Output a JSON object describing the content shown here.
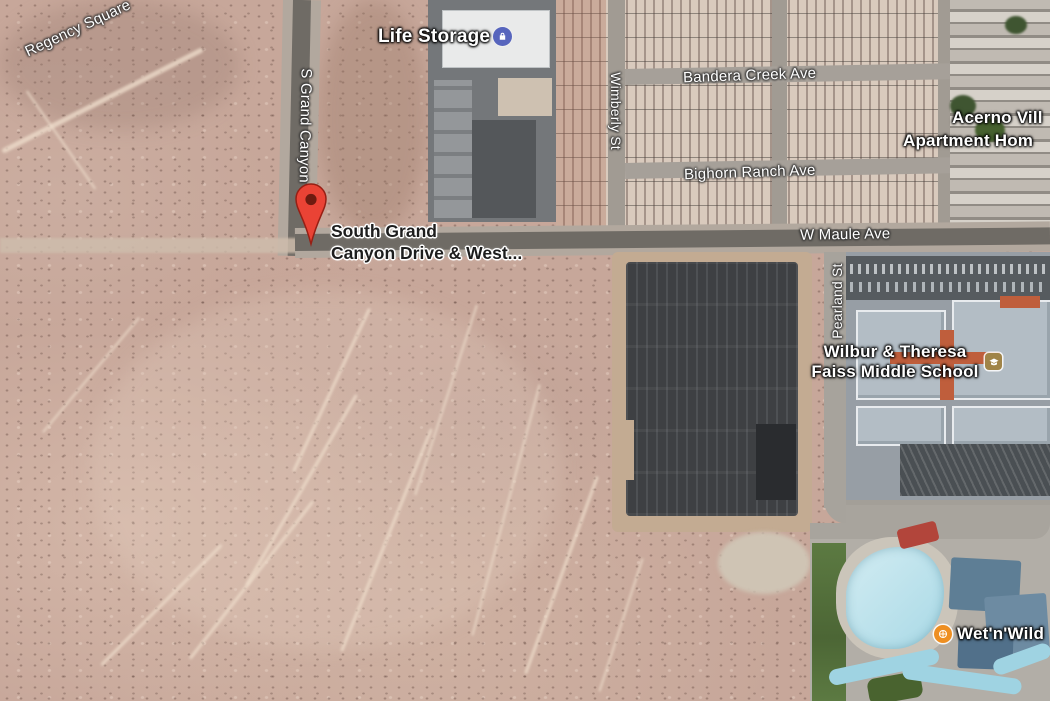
{
  "map": {
    "view": "satellite",
    "road_labels": {
      "regency_square": "Regency Square",
      "s_grand_canyon_dr": "S Grand Canyon",
      "wimberly_st": "Wimberly St",
      "bandera_creek_ave": "Bandera Creek Ave",
      "bighorn_ranch_ave": "Bighorn Ranch Ave",
      "w_maule_ave": "W Maule Ave",
      "pearland_st": "Pearland St"
    },
    "poi_labels": {
      "life_storage": "Life Storage",
      "acerno_line1": "Acerno Vill",
      "acerno_line2": "Apartment Hom",
      "school_line1": "Wilbur & Theresa",
      "school_line2": "Faiss Middle School",
      "wet_n_wild": "Wet'n'Wild"
    },
    "marker": {
      "title_line1": "South Grand",
      "title_line2": "Canyon Drive & West...",
      "pin_color": "#EA4335"
    },
    "icon_colors": {
      "life_storage_icon": "#5765BD",
      "school_icon": "#A08448",
      "wet_n_wild_icon": "#EE8F22"
    }
  }
}
